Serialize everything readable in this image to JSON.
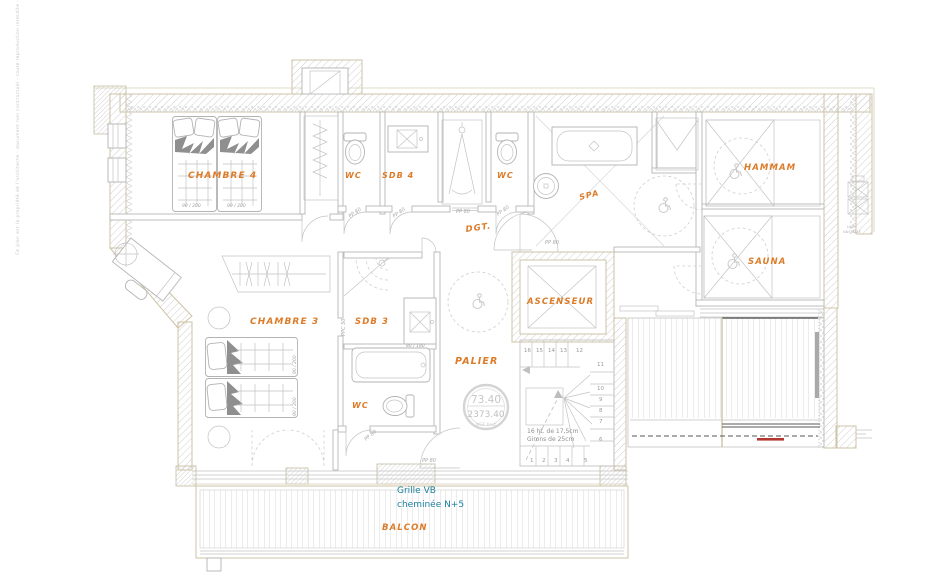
{
  "colors": {
    "orange": "#dc7b28",
    "teal": "#1b7f9e",
    "beige": "#cdc3a5",
    "red": "#b23730"
  },
  "side_note": "Ce plan est la propriété de l'architecte - document non contractuel - toute reproduction interdite - cotes à vérifier sur place",
  "rooms": {
    "chambre4": "CHAMBRE 4",
    "wc1": "WC",
    "sdb4": "SDB 4",
    "wc2": "WC",
    "spa": "SPA",
    "dgt": "DGT.",
    "hammam": "HAMMAM",
    "sauna": "SAUNA",
    "ascenseur": "ASCENSEUR",
    "palier": "PALIER",
    "chambre3": "CHAMBRE 3",
    "sdb3": "SDB 3",
    "wc3": "WC",
    "balcon": "BALCON"
  },
  "annotation": {
    "line1": "Grille VB",
    "line2": "cheminée N+5"
  },
  "elevation": {
    "value": "73.40",
    "ngf": "2373.40",
    "ref": "NGF brut"
  },
  "stairs": {
    "top": [
      "16",
      "15",
      "14",
      "13",
      "12"
    ],
    "right": [
      "11",
      "10",
      "9",
      "8",
      "7",
      "6"
    ],
    "bottom": [
      "1",
      "2",
      "3",
      "4",
      "5"
    ],
    "note1": "16 ht. de 17,5cm",
    "note2": "Girons de 25cm"
  },
  "doors": {
    "pp80": "PP 80",
    "ppc50": "PPC 50"
  },
  "dims": {
    "bed": "90 / 200",
    "tub": "80 / 180"
  },
  "equipment": {
    "lv1": "LAVE",
    "lv2": "VAISSELLE"
  }
}
